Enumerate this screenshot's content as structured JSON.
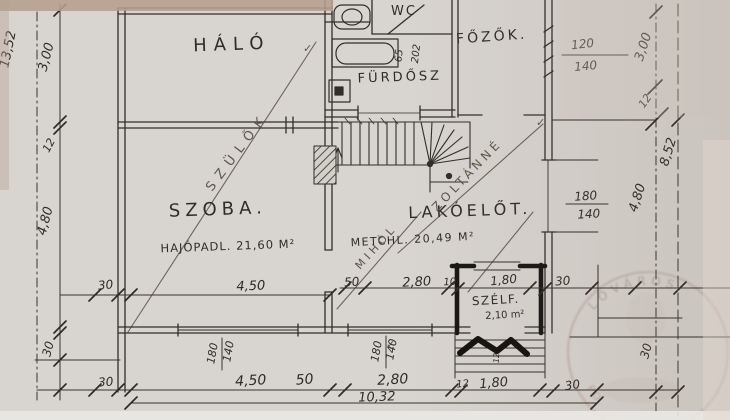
{
  "rooms": {
    "halo": "HÁLÓ",
    "szoba": "SZOBA.",
    "szoba_floor": "HAJÓPADL. 21,60 M²",
    "wc": "WC",
    "furdo": "FÜRDŐSZ",
    "fozo": "FŐZŐK.",
    "lakoelo": "LAKÓELŐT.",
    "lakoelo_floor": "METCHL. 20,49 M²",
    "szelf": "SZÉLF.",
    "szelf_area": "2,10 m²"
  },
  "annotations": {
    "parents": "SZÜLŐK",
    "name1": "ZOLTÁNNÉ",
    "name2": "MIHÓL",
    "check1": "✓",
    "check2": "✓",
    "check3": "✓"
  },
  "dims": {
    "left_total": "13,52",
    "left_a": "3,00",
    "left_wall": "12",
    "left_b": "4,80",
    "left_low": "30",
    "right_a": "3,00",
    "right_wall": "12",
    "right_total": "8,52",
    "right_b": "4,80",
    "right_low": "30",
    "bot_a": "30",
    "bot_b": "4,50",
    "bot_c": "50",
    "bot_d": "2,80",
    "bot_e": "12",
    "bot_f": "1,80",
    "bot_g": "30",
    "bot_total": "10,32",
    "szoba_w": "4,50",
    "szoba_off": "30",
    "in_a": "50",
    "in_b": "2,80",
    "in_c": "10",
    "in_d": "1,80",
    "in_e": "30",
    "bath_a": "65",
    "bath_b": "202",
    "steps": "12",
    "winbl_w": "180",
    "winbl_h": "140",
    "winbr_w": "180",
    "winbr_h": "140",
    "wink_w": "120",
    "wink_h": "140",
    "winr_w": "180",
    "winr_h": "140"
  },
  "stamp": {
    "arc_top": "LŐVÁROS",
    "arc_left": "PO"
  },
  "colors": {
    "paper": "#d8d4cf",
    "ink": "#34312c",
    "pencil": "#5f594f",
    "stamp": "#a8877f"
  }
}
